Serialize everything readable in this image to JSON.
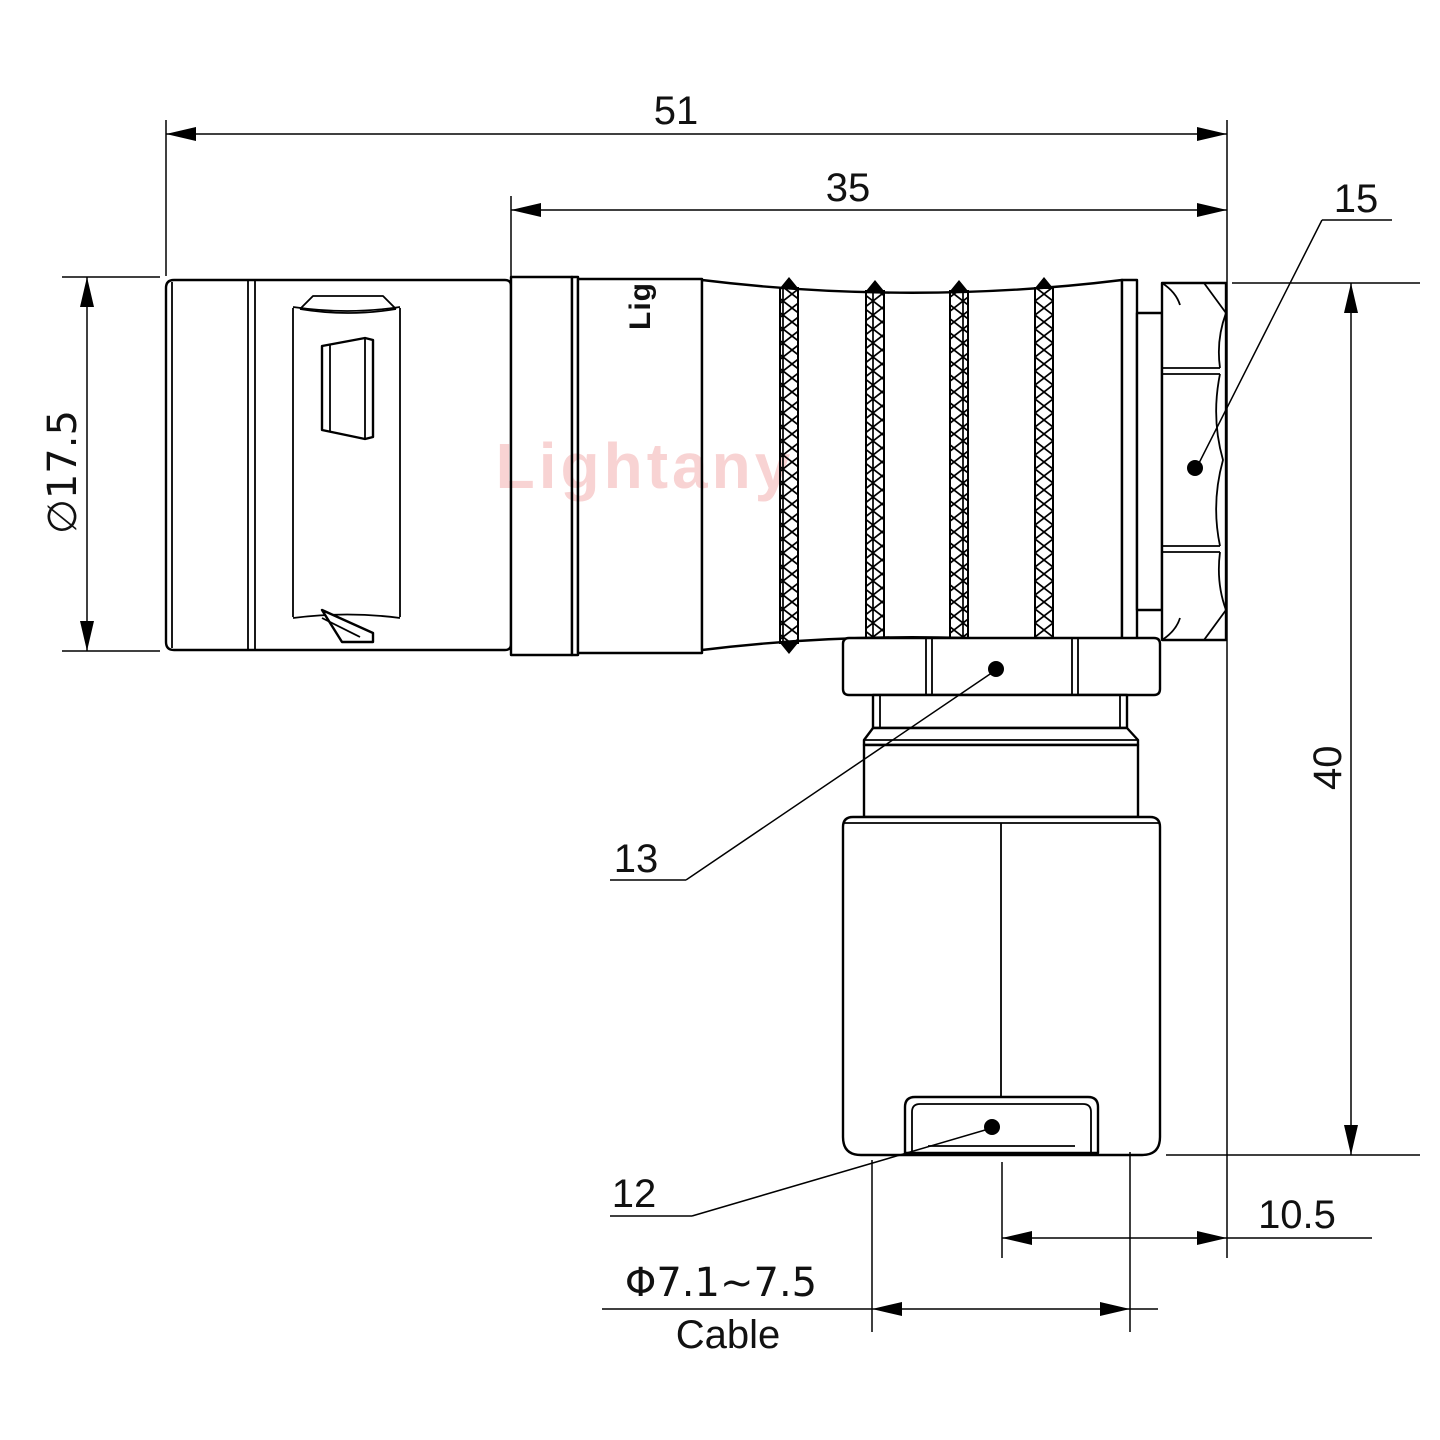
{
  "drawing": {
    "watermark": "Lightany",
    "body_mark": "Lig",
    "dimensions": {
      "overall_length": "51",
      "grip_length": "35",
      "plug_diameter": "∅17.5",
      "overall_height": "40",
      "center_to_face": "10.5",
      "backnut_label": "15",
      "coupling_nut_label": "13",
      "sleeve_label": "12",
      "cable_diameter": "Φ7.1~7.5",
      "cable_word": "Cable"
    }
  }
}
